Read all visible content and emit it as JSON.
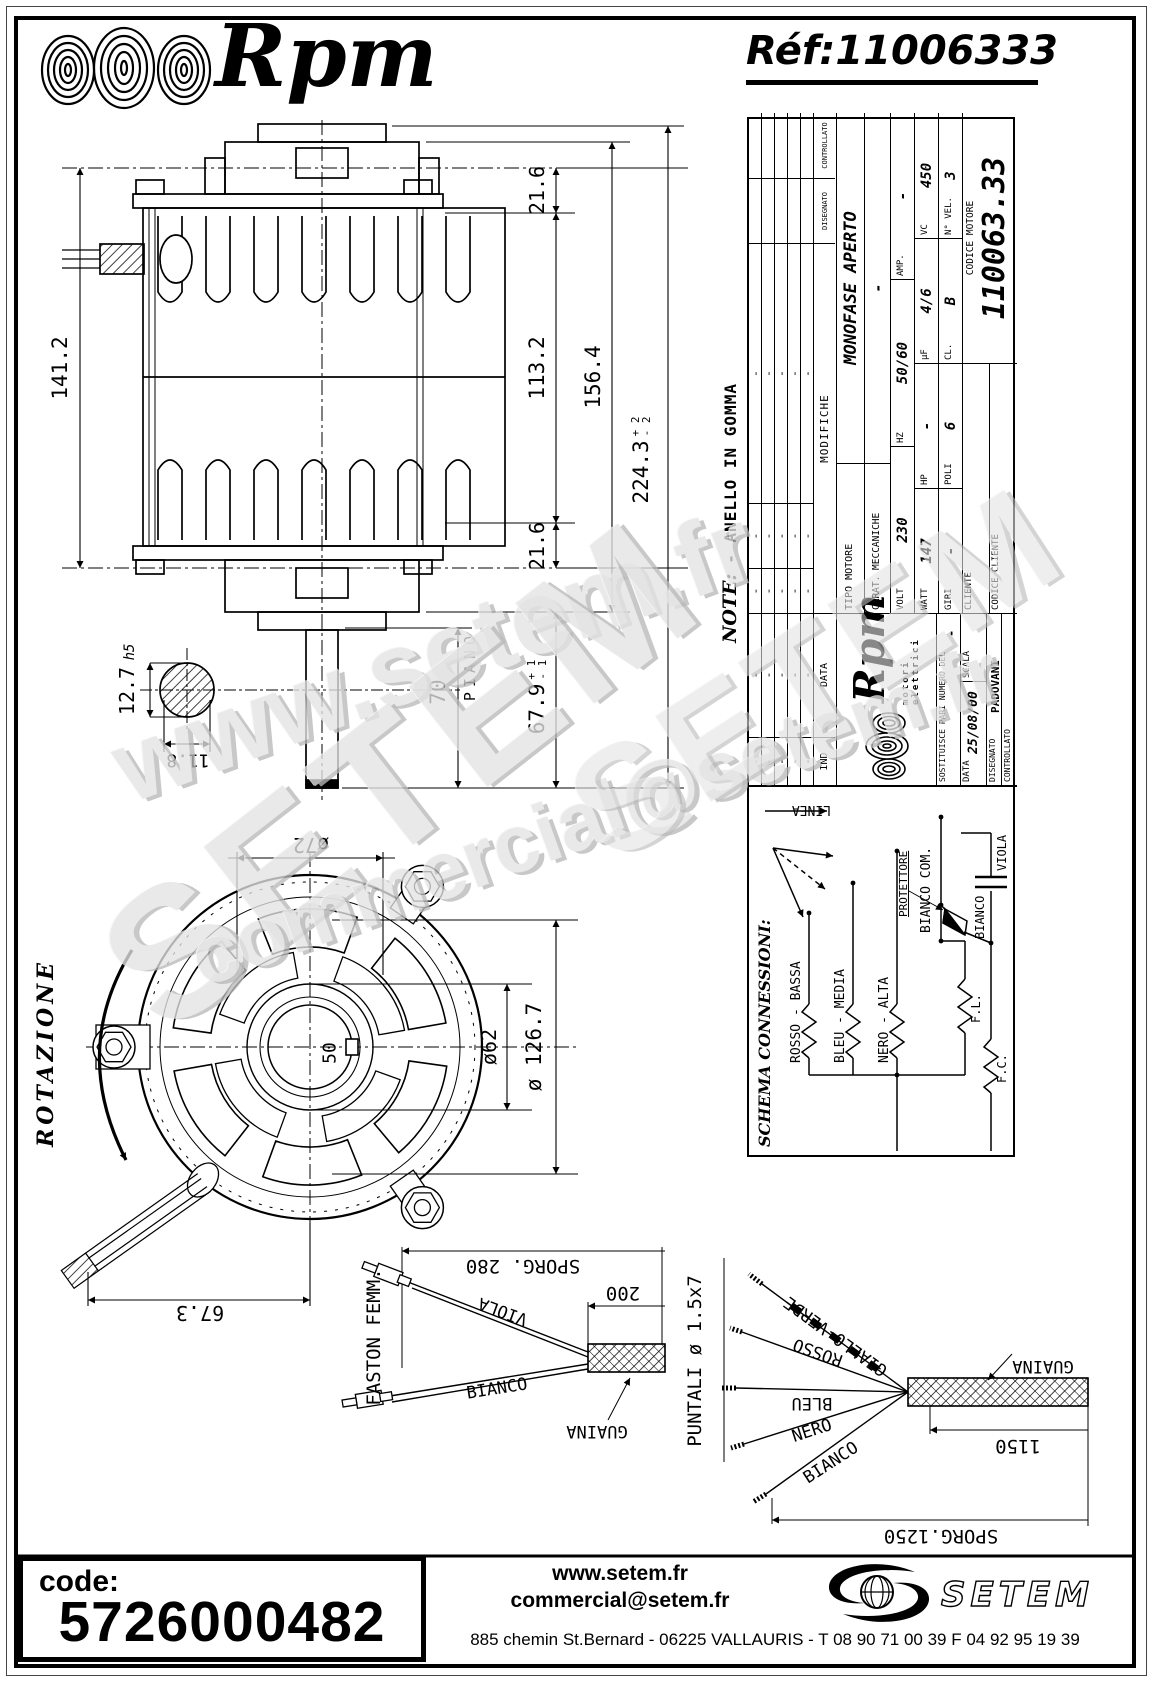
{
  "header": {
    "brand": "Rpm",
    "ref_label": "Réf:",
    "ref_value": "11006333"
  },
  "side_view": {
    "dim_141_2": "141.2",
    "dim_21_6_top": "21.6",
    "dim_113_2": "113.2",
    "dim_21_6_bottom": "21.6",
    "dim_156_4": "156.4",
    "dim_224_3": "224.3",
    "tol_224_plus": "+ 2",
    "tol_224_minus": "- 2",
    "dim_67_9": "67.9",
    "tol_67_plus": "+ 1",
    "tol_67_minus": "- 1",
    "dim_70": "70",
    "piano": "PIANO",
    "dim_12_7": "12.7",
    "fit_h5": "h5",
    "dim_11_8": "11.8"
  },
  "front_view": {
    "rotazione": "ROTAZIONE",
    "dia_72": "ø72",
    "dia_62": "ø62",
    "dia_126_7": "ø 126.7",
    "dim_50": "50",
    "dim_67_3": "67.3"
  },
  "title_block": {
    "note_label": "NOTE:",
    "note_text": "- ANELLO IN GOMMA",
    "revisions": {
      "ind": "IND",
      "data": "DATA",
      "rows": [
        [
          "-",
          "-"
        ],
        [
          "-",
          "-"
        ],
        [
          "-",
          "-"
        ],
        [
          "-",
          "-"
        ],
        [
          "-",
          "-"
        ]
      ]
    },
    "modifiche": {
      "header": "MODIFICHE",
      "disegnato": "DISEGNATO",
      "controllato": "CONTROLLATO",
      "rows": [
        [
          "-",
          "-",
          "-"
        ],
        [
          "-",
          "-",
          "-"
        ],
        [
          "-",
          "-",
          "-"
        ],
        [
          "-",
          "-",
          "-"
        ],
        [
          "-",
          "-",
          "-"
        ]
      ]
    },
    "tipo_label": "TIPO MOTORE",
    "tipo_value": "MONOFASE APERTO",
    "carat_label": "CARAT. MECCANICHE",
    "carat_value": "-",
    "volt_label": "VOLT",
    "volt_value": "230",
    "hz_label": "HZ",
    "hz_value": "50/60",
    "amp_label": "AMP.",
    "amp_value": "-",
    "watt_label": "WATT",
    "watt_value": "147",
    "hp_label": "HP",
    "hp_value": "-",
    "uf_label": "µF",
    "uf_value": "4/6",
    "vc_label": "VC",
    "vc_value": "450",
    "giri_label": "GIRI",
    "giri_value": "-",
    "poli_label": "POLI",
    "poli_value": "6",
    "cl_label": "CL.",
    "cl_value": "B",
    "nvel_label": "N° VEL.",
    "nvel_value": "3",
    "cliente_label": "CLIENTE",
    "codice_cliente_label": "CODICE CLIENTE",
    "codice_motore_label": "CODICE MOTORE",
    "codice_motore_value": "110063.33",
    "logo_text": "Rpm",
    "logo_sub": "motori elettrici",
    "sostituisce_label": "SOSTITUISCE PARI NUMERO DEL",
    "sostituisce_value": "-",
    "data_label": "DATA",
    "data_value": "25/08/00",
    "scala_label": "SCALA",
    "disegnato_label": "DISEGNATO",
    "disegnato_value": "PADOVANI",
    "controllato_label": "CONTROLLATO"
  },
  "schema": {
    "title": "SCHEMA CONNESSIONI:",
    "linea": "LINEA",
    "rosso": "ROSSO - BASSA",
    "bleu": "BLEU - MEDIA",
    "nero": "NERO - ALTA",
    "bianco_com": "BIANCO COM.",
    "protettore": "PROTETTORE",
    "bianco": "BIANCO",
    "viola": "VIOLA",
    "fl": "F.L.",
    "fc": "F.C."
  },
  "cable_left": {
    "faston": "FASTON FEMM.",
    "sporg": "SPORG. 280",
    "dim_200": "200",
    "viola": "VIOLA",
    "bianco": "BIANCO",
    "guaina": "GUAINA"
  },
  "cable_right": {
    "puntali": "PUNTALI ø 1.5x7",
    "giallo_verde": "GIALLO-VERDE",
    "rosso": "ROSSO",
    "bleu": "BLEU",
    "nero": "NERO",
    "bianco": "BIANCO",
    "guaina": "GUAINA",
    "dim_1150": "1150",
    "sporg": "SPORG.1250"
  },
  "watermarks": {
    "w1": "www.setem.fr",
    "w2": "SETEM",
    "w3": "commercial@setem.fr",
    "w4": "SETEM"
  },
  "footer": {
    "code_label": "code:",
    "code_value": "5726000482",
    "site": "www.setem.fr",
    "email": "commercial@setem.fr",
    "logo": "SETEM",
    "address": "885 chemin St.Bernard  -  06225 VALLAURIS  -  T 08 90 71 00 39   F 04 92 95 19 39"
  }
}
